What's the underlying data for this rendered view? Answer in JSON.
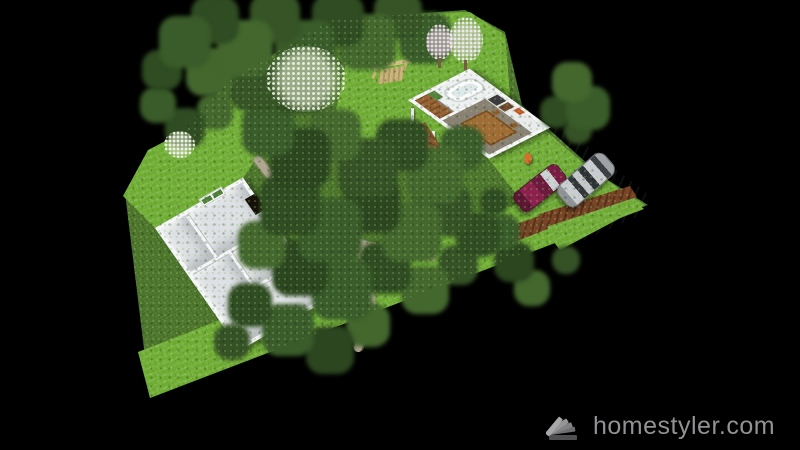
{
  "app": {
    "name": "Homestyler 3D render",
    "background_color": "#000000"
  },
  "watermark": {
    "text": "homestyler.com",
    "logo_icon": "homestyler-fan-logo",
    "text_color": "#929295"
  },
  "scene": {
    "description": "Aerial 3D perspective render of a landscaped plot with a main house floor plan, a guest house with carport, lawns, stone paths and dense trees on a black background",
    "colors": {
      "lawn_bright": "#6fae32",
      "ground_base": "#4d772b",
      "tree_dark": "#2c4620",
      "tree_mid": "#3a5c2a",
      "tree_light": "#44672e",
      "wall_white": "#f4f6f8",
      "floor_gray": "#dde0e4",
      "stone_path": "#b3a996",
      "garage_door_brown": "#7a4526",
      "car_silver": "#c9cdd1",
      "car_maroon": "#8e2050",
      "wood": "#a06c36",
      "blossom_white": "#f2f6ea",
      "blossom_pink": "#ecdce8"
    },
    "objects": {
      "main_house": {
        "label": "Main house — empty roofless floor plan with five rooms",
        "features": [
          "green shuttered window on upper wall",
          "dark open doorway on side wall"
        ]
      },
      "guest_house": {
        "label": "Guest house wing",
        "features": [
          "bathtub",
          "green bathroom door",
          "wood cabinet",
          "kitchen counter with dark appliances",
          "wooden dining table with chairs",
          "orange wall art"
        ]
      },
      "carport": {
        "label": "Carport with two parked cars",
        "cars": [
          {
            "type": "silver SUV",
            "color": "#c9cdd1"
          },
          {
            "type": "maroon sedan",
            "color": "#8e2050"
          }
        ],
        "extras": [
          "brown slatted garage doors",
          "orange figure",
          "white gate posts",
          "wooden entry deck"
        ]
      },
      "garden": {
        "label": "Garden",
        "features": [
          "dense green tree canopy",
          "white and pink flowering trees",
          "wooden swing bench",
          "stone footpath",
          "bright mowed lawn strip along the front"
        ]
      }
    }
  }
}
